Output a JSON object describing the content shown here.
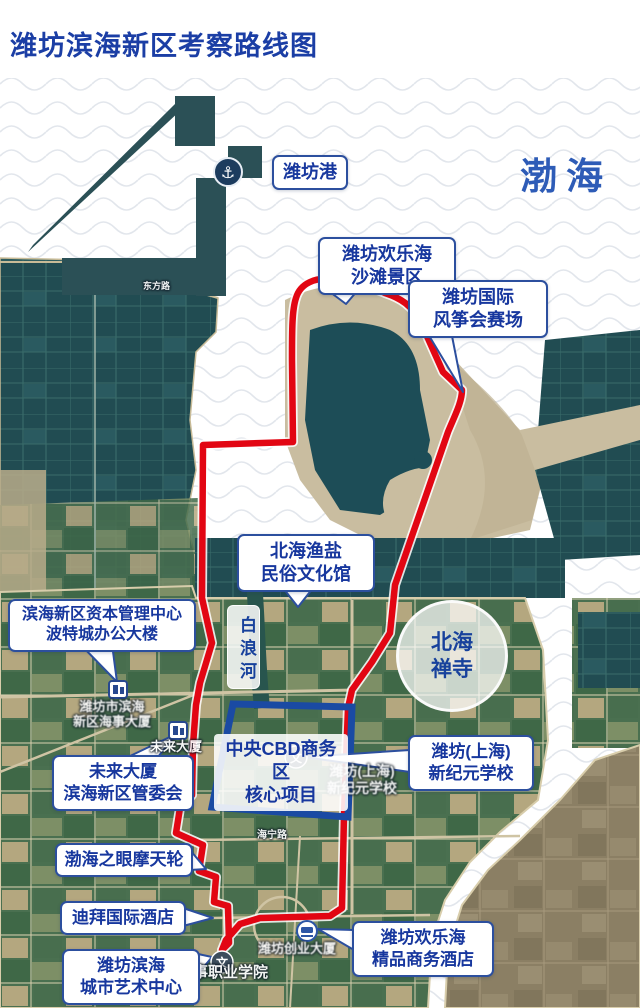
{
  "header": {
    "title": "潍坊滨海新区考察路线图"
  },
  "sea": {
    "label": "渤海"
  },
  "callouts": {
    "port": {
      "label": "潍坊港"
    },
    "beach": {
      "line1": "潍坊欢乐海",
      "line2": "沙滩景区"
    },
    "kite": {
      "line1": "潍坊国际",
      "line2": "风筝会赛场"
    },
    "fishery": {
      "line1": "北海渔盐",
      "line2": "民俗文化馆"
    },
    "capital": {
      "line1": "滨海新区资本管理中心",
      "line2": "波特城办公大楼"
    },
    "river": {
      "label": "白浪河"
    },
    "temple": {
      "line1": "北海",
      "line2": "禅寺"
    },
    "cbd": {
      "line1": "中央CBD商务区",
      "line2": "核心项目"
    },
    "school": {
      "line1": "潍坊(上海)",
      "line2": "新纪元学校"
    },
    "future": {
      "line1": "未来大厦",
      "line2": "滨海新区管委会"
    },
    "ferris": {
      "label": "渤海之眼摩天轮"
    },
    "dubai": {
      "label": "迪拜国际酒店"
    },
    "artcenter": {
      "line1": "潍坊滨海",
      "line2": "城市艺术中心"
    },
    "hotel": {
      "line1": "潍坊欢乐海",
      "line2": "精品商务酒店"
    }
  },
  "map_labels": {
    "road_top": "东方路",
    "customs1": "潍坊市滨海",
    "customs2": "新区海事大厦",
    "future_building": "未来大厦",
    "school1": "潍坊(上海)",
    "school2": "新纪元学校",
    "road_haining": "海宁路",
    "chuangye": "潍坊创业大厦",
    "college": "山东海事职业学院"
  },
  "icons": {
    "anchor": "⚓",
    "school_marker": "文"
  },
  "colors": {
    "route_red": "#e20613",
    "cbd_blue": "#1a4aa3",
    "callout_border": "#2c4f9e",
    "callout_text": "#17379e",
    "sea_text": "#2e5cb7",
    "title_text": "#1b3ea5"
  }
}
